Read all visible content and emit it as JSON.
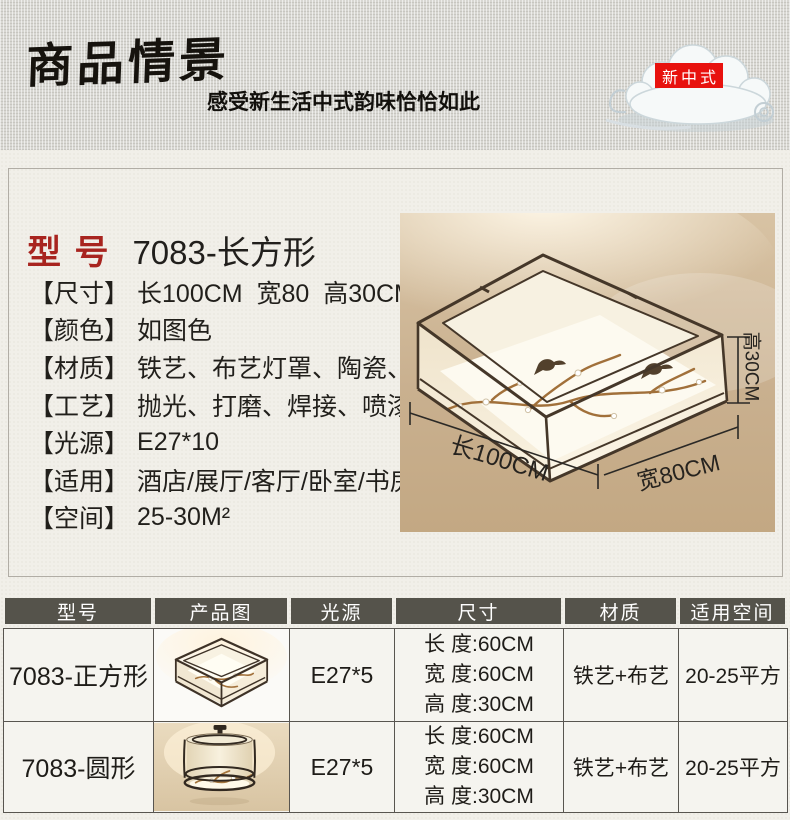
{
  "banner": {
    "title": "商品情景",
    "subtitle": "感受新生活中式韵味恰恰如此",
    "badge_label": "新中式"
  },
  "icons": {
    "banner_decoration": "auspicious-cloud"
  },
  "colors": {
    "banner_bg": "#d8d7d2",
    "page_bg": "#f1efe9",
    "badge_red": "#e8120e",
    "model_red": "#a8241f",
    "table_header_bg": "#55534b",
    "photo_ceiling_tan": "#c9b08f",
    "lamp_frame_brown": "#453729",
    "branch_brass": "#a1703a"
  },
  "product_card": {
    "model_label": "型 号",
    "model_value": "7083-长方形",
    "specs": [
      {
        "label": "【尺寸】",
        "value": "长100CM  宽80  高30CM"
      },
      {
        "label": "【颜色】",
        "value": "如图色"
      },
      {
        "label": "【材质】",
        "value": "铁艺、布艺灯罩、陶瓷、铜"
      },
      {
        "label": "【工艺】",
        "value": "抛光、打磨、焊接、喷漆"
      },
      {
        "label": "【光源】",
        "value": "E27*10"
      },
      {
        "label": "【适用】",
        "value": "酒店/展厅/客厅/卧室/书房/餐厅"
      },
      {
        "label": "【空间】",
        "value": "25-30M²"
      }
    ],
    "photo_annotations": {
      "height": "高30CM",
      "length": "长100CM",
      "width": "宽80CM"
    }
  },
  "spec_table": {
    "headers": [
      "型号",
      "产品图",
      "光源",
      "尺寸",
      "材质",
      "适用空间"
    ],
    "rows": [
      {
        "model": "7083-正方形",
        "photo": "square-ceiling-lamp",
        "light_source": "E27*5",
        "dimensions": [
          "长 度:60CM",
          "宽 度:60CM",
          "高 度:30CM"
        ],
        "material": "铁艺+布艺",
        "space": "20-25平方"
      },
      {
        "model": "7083-圆形",
        "photo": "round-ceiling-lamp",
        "light_source": "E27*5",
        "dimensions": [
          "长 度:60CM",
          "宽 度:60CM",
          "高 度:30CM"
        ],
        "material": "铁艺+布艺",
        "space": "20-25平方"
      }
    ]
  }
}
